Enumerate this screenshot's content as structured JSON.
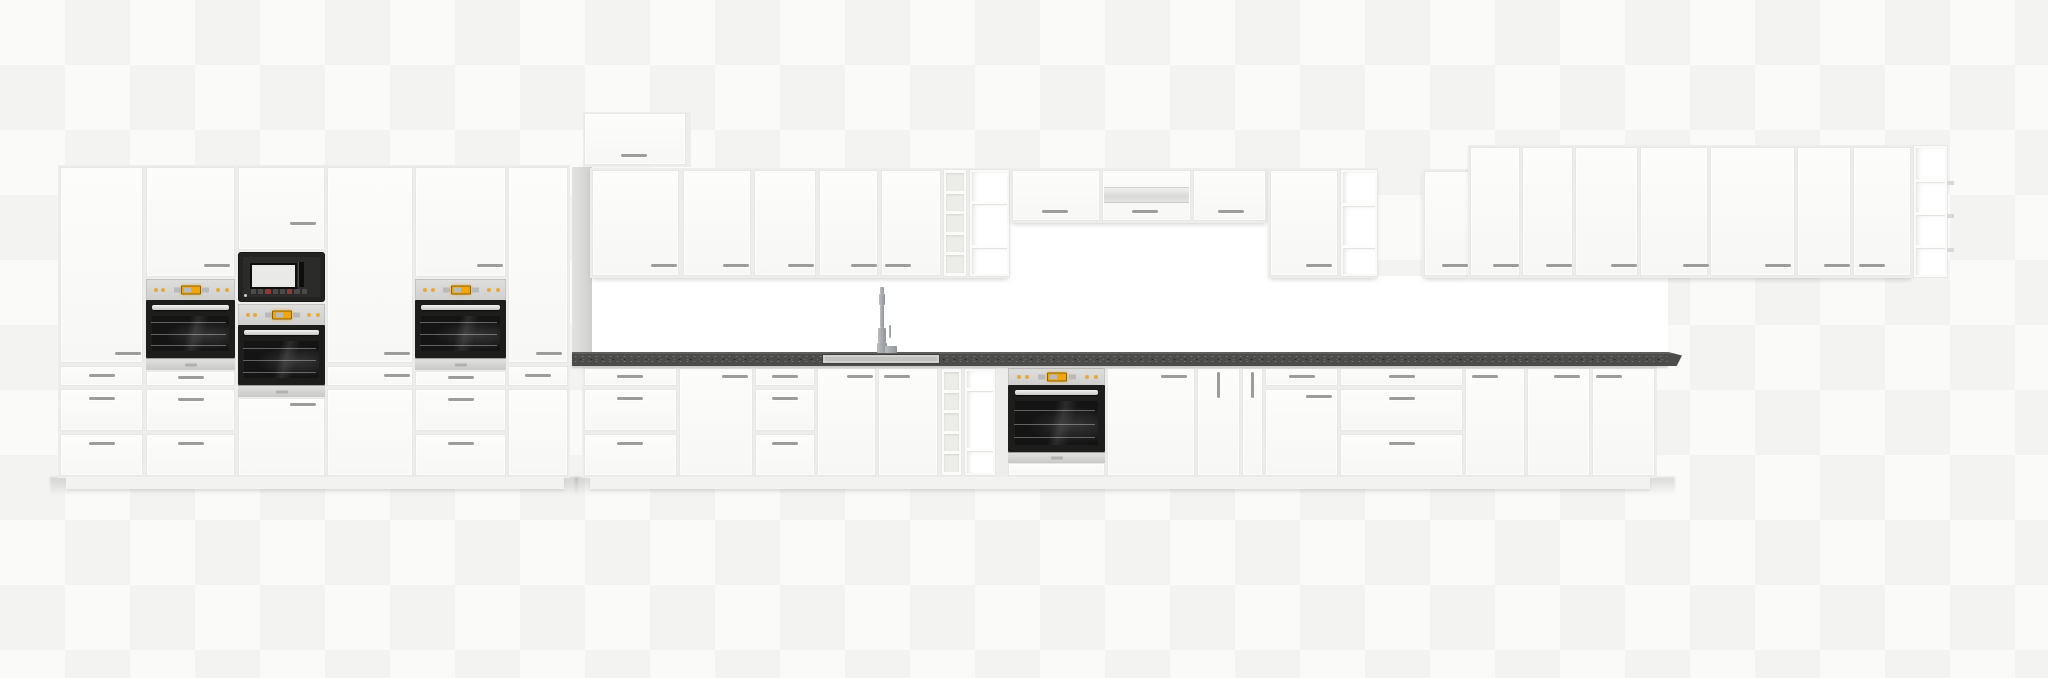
{
  "scene": {
    "canvas": {
      "w": 2048,
      "h": 678
    },
    "palette": {
      "canvas_bg": "#fafaf9",
      "grid": "#f3f3f1",
      "cabinet_front": "#fcfcfb",
      "cabinet_body": "#ededeb",
      "front_border": "#e7e7e5",
      "handle": "#9c9c9c",
      "backsplash": "#ffffff",
      "filler_light": "#e3e3e1",
      "filler_dark": "#cfcfcd",
      "countertop": "#4c4c4a",
      "countertop_edge": "#5e5e5c",
      "sink": "#c2c2c0",
      "appliance_black": "#1d1d1c",
      "glass": "#141414",
      "amber": "#f2a60d"
    },
    "modules": [
      {
        "t": "shadow",
        "name": "floor-shadow-left",
        "x": 50,
        "y": 477,
        "w": 528,
        "h": 26
      },
      {
        "t": "shadow",
        "name": "floor-shadow-base-run",
        "x": 575,
        "y": 477,
        "w": 1100,
        "h": 26
      },
      {
        "t": "backsplash",
        "name": "backsplash",
        "x": 582,
        "y": 276,
        "w": 1086,
        "h": 78
      },
      {
        "t": "backsplash",
        "name": "backsplash-hood-zone",
        "x": 1008,
        "y": 222,
        "w": 262,
        "h": 56
      },
      {
        "t": "body",
        "name": "tall-cabinet-run-body",
        "x": 58,
        "y": 165,
        "w": 512,
        "h": 313
      },
      {
        "t": "plinth",
        "name": "plinth-left-run",
        "x": 66,
        "y": 477,
        "w": 498,
        "h": 12
      },
      {
        "t": "front",
        "name": "tall-cabinet-door",
        "x": 60,
        "y": 167,
        "w": 83,
        "h": 196,
        "handles": [
          {
            "x": 114,
            "y": 351
          }
        ]
      },
      {
        "t": "front",
        "name": "drawer-front",
        "x": 60,
        "y": 366,
        "w": 83,
        "h": 20,
        "handles": [
          {
            "x": 88,
            "y": 373
          }
        ]
      },
      {
        "t": "front",
        "name": "drawer-front",
        "x": 60,
        "y": 389,
        "w": 83,
        "h": 42,
        "handles": [
          {
            "x": 88,
            "y": 396
          }
        ]
      },
      {
        "t": "front",
        "name": "drawer-front",
        "x": 60,
        "y": 434,
        "w": 83,
        "h": 42,
        "handles": [
          {
            "x": 88,
            "y": 441
          }
        ]
      },
      {
        "t": "front",
        "name": "oven-housing-door",
        "x": 146,
        "y": 167,
        "w": 89,
        "h": 110,
        "handles": [
          {
            "x": 203,
            "y": 263
          }
        ]
      },
      {
        "t": "oven",
        "name": "built-in-oven",
        "x": 146,
        "y": 279,
        "w": 89,
        "ctrl": 20,
        "door": 58,
        "strip": 11
      },
      {
        "t": "front",
        "name": "drawer-front",
        "x": 146,
        "y": 371,
        "w": 89,
        "h": 15,
        "handles": [
          {
            "x": 177,
            "y": 375
          }
        ]
      },
      {
        "t": "front",
        "name": "drawer-front",
        "x": 146,
        "y": 389,
        "w": 89,
        "h": 42,
        "handles": [
          {
            "x": 177,
            "y": 397
          }
        ]
      },
      {
        "t": "front",
        "name": "drawer-front",
        "x": 146,
        "y": 434,
        "w": 89,
        "h": 42,
        "handles": [
          {
            "x": 177,
            "y": 441
          }
        ]
      },
      {
        "t": "front",
        "name": "microwave-housing-door",
        "x": 238,
        "y": 167,
        "w": 87,
        "h": 83,
        "handles": [
          {
            "x": 289,
            "y": 221
          }
        ]
      },
      {
        "t": "microwave",
        "name": "built-in-microwave",
        "x": 238,
        "y": 252,
        "w": 87,
        "h": 50
      },
      {
        "t": "oven",
        "name": "built-in-oven",
        "x": 238,
        "y": 304,
        "w": 87,
        "ctrl": 20,
        "door": 60,
        "strip": 11
      },
      {
        "t": "front",
        "name": "cabinet-door",
        "x": 238,
        "y": 398,
        "w": 87,
        "h": 78,
        "handles": [
          {
            "x": 289,
            "y": 402
          }
        ]
      },
      {
        "t": "front",
        "name": "tall-cabinet-door",
        "x": 327,
        "y": 167,
        "w": 86,
        "h": 196,
        "handles": [
          {
            "x": 383,
            "y": 351
          }
        ]
      },
      {
        "t": "front",
        "name": "drawer-front",
        "x": 327,
        "y": 366,
        "w": 86,
        "h": 20,
        "handles": [
          {
            "x": 383,
            "y": 373
          }
        ]
      },
      {
        "t": "front",
        "name": "cabinet-door",
        "x": 327,
        "y": 389,
        "w": 86,
        "h": 87
      },
      {
        "t": "front",
        "name": "oven-housing-door",
        "x": 415,
        "y": 167,
        "w": 91,
        "h": 110,
        "handles": [
          {
            "x": 476,
            "y": 263
          }
        ]
      },
      {
        "t": "oven",
        "name": "built-in-oven",
        "x": 415,
        "y": 279,
        "w": 91,
        "ctrl": 20,
        "door": 58,
        "strip": 11
      },
      {
        "t": "front",
        "name": "drawer-front",
        "x": 415,
        "y": 371,
        "w": 91,
        "h": 15,
        "handles": [
          {
            "x": 447,
            "y": 375
          }
        ]
      },
      {
        "t": "front",
        "name": "drawer-front",
        "x": 415,
        "y": 389,
        "w": 91,
        "h": 42,
        "handles": [
          {
            "x": 447,
            "y": 397
          }
        ]
      },
      {
        "t": "front",
        "name": "drawer-front",
        "x": 415,
        "y": 434,
        "w": 91,
        "h": 42,
        "handles": [
          {
            "x": 447,
            "y": 441
          }
        ]
      },
      {
        "t": "front",
        "name": "tall-cabinet-door",
        "x": 508,
        "y": 167,
        "w": 60,
        "h": 196,
        "handles": [
          {
            "x": 535,
            "y": 351
          }
        ]
      },
      {
        "t": "front",
        "name": "drawer-front",
        "x": 508,
        "y": 366,
        "w": 60,
        "h": 20,
        "handles": [
          {
            "x": 524,
            "y": 373
          }
        ]
      },
      {
        "t": "front",
        "name": "cabinet-door",
        "x": 508,
        "y": 389,
        "w": 60,
        "h": 87
      },
      {
        "t": "filler",
        "name": "side-filler-panel",
        "x": 572,
        "y": 167,
        "w": 20,
        "h": 186
      },
      {
        "t": "body",
        "name": "top-box-body",
        "x": 583,
        "y": 112,
        "w": 108,
        "h": 55
      },
      {
        "t": "front",
        "name": "top-box-door",
        "x": 584,
        "y": 113,
        "w": 102,
        "h": 52,
        "handles": [
          {
            "x": 620,
            "y": 153
          }
        ]
      },
      {
        "t": "body",
        "name": "wall-cabinet-run-body",
        "x": 590,
        "y": 168,
        "w": 420,
        "h": 110,
        "wall": true
      },
      {
        "t": "front",
        "name": "wall-cabinet-door",
        "x": 592,
        "y": 170,
        "w": 87,
        "h": 106,
        "handles": [
          {
            "x": 650,
            "y": 263
          }
        ]
      },
      {
        "t": "front",
        "name": "wall-cabinet-door",
        "x": 683,
        "y": 170,
        "w": 68,
        "h": 106,
        "handles": [
          {
            "x": 722,
            "y": 263
          }
        ]
      },
      {
        "t": "front",
        "name": "wall-cabinet-door",
        "x": 754,
        "y": 170,
        "w": 62,
        "h": 106,
        "handles": [
          {
            "x": 787,
            "y": 263
          }
        ]
      },
      {
        "t": "front",
        "name": "wall-cabinet-door",
        "x": 819,
        "y": 170,
        "w": 59,
        "h": 106,
        "handles": [
          {
            "x": 850,
            "y": 263
          }
        ]
      },
      {
        "t": "front",
        "name": "wall-cabinet-door",
        "x": 881,
        "y": 170,
        "w": 60,
        "h": 106,
        "handles": [
          {
            "x": 884,
            "y": 263
          }
        ]
      },
      {
        "t": "wine",
        "name": "wall-wine-rack",
        "x": 943,
        "y": 169,
        "w": 24,
        "h": 108,
        "cells": 5
      },
      {
        "t": "shelf",
        "name": "wall-open-shelf",
        "x": 969,
        "y": 169,
        "w": 41,
        "h": 108,
        "rows": [
          30,
          40,
          26
        ]
      },
      {
        "t": "body",
        "name": "hood-cabinet-run-body",
        "x": 1010,
        "y": 168,
        "w": 258,
        "h": 55,
        "wall": true
      },
      {
        "t": "front",
        "name": "wall-cabinet-door",
        "x": 1012,
        "y": 170,
        "w": 88,
        "h": 51,
        "handles": [
          {
            "x": 1041,
            "y": 209
          }
        ]
      },
      {
        "t": "front",
        "name": "hood-flap-door",
        "x": 1102,
        "y": 170,
        "w": 89,
        "h": 51,
        "handles": [
          {
            "x": 1131,
            "y": 209
          }
        ]
      },
      {
        "t": "hood",
        "name": "cooker-hood",
        "x": 1104,
        "y": 187,
        "w": 85,
        "h": 16
      },
      {
        "t": "front",
        "name": "wall-cabinet-door",
        "x": 1193,
        "y": 170,
        "w": 73,
        "h": 51,
        "handles": [
          {
            "x": 1217,
            "y": 209
          }
        ]
      },
      {
        "t": "body",
        "name": "wall-cabinet-body",
        "x": 1268,
        "y": 168,
        "w": 110,
        "h": 110,
        "wall": true
      },
      {
        "t": "front",
        "name": "wall-cabinet-door",
        "x": 1270,
        "y": 170,
        "w": 68,
        "h": 106,
        "handles": [
          {
            "x": 1305,
            "y": 263
          }
        ]
      },
      {
        "t": "shelf",
        "name": "wall-open-shelf",
        "x": 1340,
        "y": 169,
        "w": 38,
        "h": 108,
        "rows": [
          32,
          38,
          26
        ]
      },
      {
        "t": "body",
        "name": "wall-cabinet-body",
        "x": 1422,
        "y": 169,
        "w": 49,
        "h": 109,
        "wall": true
      },
      {
        "t": "front",
        "name": "wall-cabinet-door",
        "x": 1424,
        "y": 171,
        "w": 45,
        "h": 105,
        "handles": [
          {
            "x": 1441,
            "y": 263
          }
        ]
      },
      {
        "t": "body",
        "name": "tall-wall-cabinet-run-body",
        "x": 1468,
        "y": 145,
        "w": 445,
        "h": 133,
        "wall": true
      },
      {
        "t": "front",
        "name": "wall-cabinet-door",
        "x": 1470,
        "y": 147,
        "w": 50,
        "h": 129,
        "handles": [
          {
            "x": 1492,
            "y": 263
          }
        ]
      },
      {
        "t": "front",
        "name": "wall-cabinet-door",
        "x": 1522,
        "y": 147,
        "w": 51,
        "h": 129,
        "handles": [
          {
            "x": 1545,
            "y": 263
          }
        ]
      },
      {
        "t": "front",
        "name": "wall-cabinet-door",
        "x": 1575,
        "y": 147,
        "w": 63,
        "h": 129,
        "handles": [
          {
            "x": 1610,
            "y": 263
          }
        ]
      },
      {
        "t": "front",
        "name": "wall-cabinet-door",
        "x": 1640,
        "y": 147,
        "w": 68,
        "h": 129,
        "handles": [
          {
            "x": 1682,
            "y": 263
          }
        ]
      },
      {
        "t": "front",
        "name": "wall-cabinet-door",
        "x": 1710,
        "y": 147,
        "w": 85,
        "h": 129,
        "handles": [
          {
            "x": 1764,
            "y": 263
          }
        ]
      },
      {
        "t": "front",
        "name": "wall-cabinet-door",
        "x": 1797,
        "y": 147,
        "w": 54,
        "h": 129,
        "handles": [
          {
            "x": 1823,
            "y": 263
          }
        ]
      },
      {
        "t": "front",
        "name": "wall-cabinet-door",
        "x": 1853,
        "y": 147,
        "w": 58,
        "h": 129,
        "handles": [
          {
            "x": 1858,
            "y": 263
          }
        ]
      },
      {
        "t": "shelf",
        "name": "end-open-shelf",
        "x": 1913,
        "y": 145,
        "w": 35,
        "h": 133,
        "rows": [
          33,
          30,
          31,
          27
        ],
        "tabs": true
      },
      {
        "t": "body",
        "name": "base-cabinet-run-body",
        "x": 582,
        "y": 366,
        "w": 1075,
        "h": 112
      },
      {
        "t": "plinth",
        "name": "plinth-base-run",
        "x": 590,
        "y": 477,
        "w": 1060,
        "h": 12
      },
      {
        "t": "front",
        "name": "drawer-front",
        "x": 584,
        "y": 368,
        "w": 93,
        "h": 18,
        "handles": [
          {
            "x": 616,
            "y": 374
          }
        ]
      },
      {
        "t": "front",
        "name": "drawer-front",
        "x": 584,
        "y": 389,
        "w": 93,
        "h": 42,
        "handles": [
          {
            "x": 616,
            "y": 396
          }
        ]
      },
      {
        "t": "front",
        "name": "drawer-front",
        "x": 584,
        "y": 434,
        "w": 93,
        "h": 42,
        "handles": [
          {
            "x": 616,
            "y": 441
          }
        ]
      },
      {
        "t": "front",
        "name": "base-cabinet-door",
        "x": 679,
        "y": 368,
        "w": 74,
        "h": 108,
        "handles": [
          {
            "x": 721,
            "y": 374
          }
        ]
      },
      {
        "t": "front",
        "name": "drawer-front",
        "x": 755,
        "y": 368,
        "w": 60,
        "h": 18,
        "handles": [
          {
            "x": 771,
            "y": 374
          }
        ]
      },
      {
        "t": "front",
        "name": "drawer-front",
        "x": 755,
        "y": 389,
        "w": 60,
        "h": 42,
        "handles": [
          {
            "x": 771,
            "y": 396
          }
        ]
      },
      {
        "t": "front",
        "name": "drawer-front",
        "x": 755,
        "y": 434,
        "w": 60,
        "h": 42,
        "handles": [
          {
            "x": 771,
            "y": 441
          }
        ]
      },
      {
        "t": "front",
        "name": "sink-cabinet-door",
        "x": 817,
        "y": 368,
        "w": 59,
        "h": 108,
        "handles": [
          {
            "x": 846,
            "y": 374
          }
        ]
      },
      {
        "t": "front",
        "name": "sink-cabinet-door",
        "x": 878,
        "y": 368,
        "w": 60,
        "h": 108,
        "handles": [
          {
            "x": 883,
            "y": 374
          }
        ]
      },
      {
        "t": "wine",
        "name": "base-wine-rack",
        "x": 941,
        "y": 368,
        "w": 21,
        "h": 108,
        "cells": 5
      },
      {
        "t": "shelf",
        "name": "base-open-shelf",
        "x": 964,
        "y": 368,
        "w": 32,
        "h": 108,
        "rows": [
          18,
          58,
          22
        ]
      },
      {
        "t": "oven",
        "name": "built-in-oven",
        "x": 1008,
        "y": 368,
        "w": 97,
        "ctrl": 16,
        "door": 67,
        "strip": 10
      },
      {
        "t": "front",
        "name": "oven-plinth-front",
        "x": 1008,
        "y": 463,
        "w": 97,
        "h": 13
      },
      {
        "t": "front",
        "name": "base-cabinet-door",
        "x": 1107,
        "y": 368,
        "w": 88,
        "h": 108,
        "handles": [
          {
            "x": 1160,
            "y": 374
          }
        ]
      },
      {
        "t": "front",
        "name": "base-cabinet-door",
        "x": 1197,
        "y": 368,
        "w": 43,
        "h": 108,
        "handles": [
          {
            "x": 1216,
            "y": 371,
            "v": true
          }
        ]
      },
      {
        "t": "front",
        "name": "base-cabinet-door",
        "x": 1242,
        "y": 368,
        "w": 21,
        "h": 108,
        "handles": [
          {
            "x": 1250,
            "y": 371,
            "v": true
          }
        ]
      },
      {
        "t": "front",
        "name": "drawer-front",
        "x": 1265,
        "y": 368,
        "w": 73,
        "h": 18,
        "handles": [
          {
            "x": 1288,
            "y": 374
          }
        ]
      },
      {
        "t": "front",
        "name": "base-cabinet-door",
        "x": 1265,
        "y": 389,
        "w": 73,
        "h": 87,
        "handles": [
          {
            "x": 1305,
            "y": 394
          }
        ]
      },
      {
        "t": "front",
        "name": "drawer-front",
        "x": 1340,
        "y": 368,
        "w": 123,
        "h": 18,
        "handles": [
          {
            "x": 1388,
            "y": 374
          }
        ]
      },
      {
        "t": "front",
        "name": "drawer-front",
        "x": 1340,
        "y": 389,
        "w": 123,
        "h": 42,
        "handles": [
          {
            "x": 1388,
            "y": 396
          }
        ]
      },
      {
        "t": "front",
        "name": "drawer-front",
        "x": 1340,
        "y": 434,
        "w": 123,
        "h": 42,
        "handles": [
          {
            "x": 1388,
            "y": 441
          }
        ]
      },
      {
        "t": "front",
        "name": "base-cabinet-door",
        "x": 1465,
        "y": 368,
        "w": 60,
        "h": 108,
        "handles": [
          {
            "x": 1471,
            "y": 374
          }
        ]
      },
      {
        "t": "front",
        "name": "base-cabinet-door",
        "x": 1527,
        "y": 368,
        "w": 63,
        "h": 108,
        "handles": [
          {
            "x": 1553,
            "y": 374
          }
        ]
      },
      {
        "t": "front",
        "name": "base-cabinet-door",
        "x": 1592,
        "y": 368,
        "w": 63,
        "h": 108,
        "handles": [
          {
            "x": 1595,
            "y": 374
          }
        ]
      },
      {
        "t": "countertop",
        "name": "countertop",
        "x": 572,
        "y": 352,
        "w": 1096,
        "h": 14
      },
      {
        "t": "counter-end",
        "name": "countertop-end-cap",
        "x": 1668,
        "y": 352,
        "w": 14,
        "h": 14
      },
      {
        "t": "sink",
        "name": "sink",
        "x": 822,
        "y": 354,
        "w": 118,
        "h": 10
      },
      {
        "t": "faucet",
        "name": "faucet",
        "x": 872,
        "y": 287,
        "w": 28,
        "h": 66
      }
    ]
  }
}
